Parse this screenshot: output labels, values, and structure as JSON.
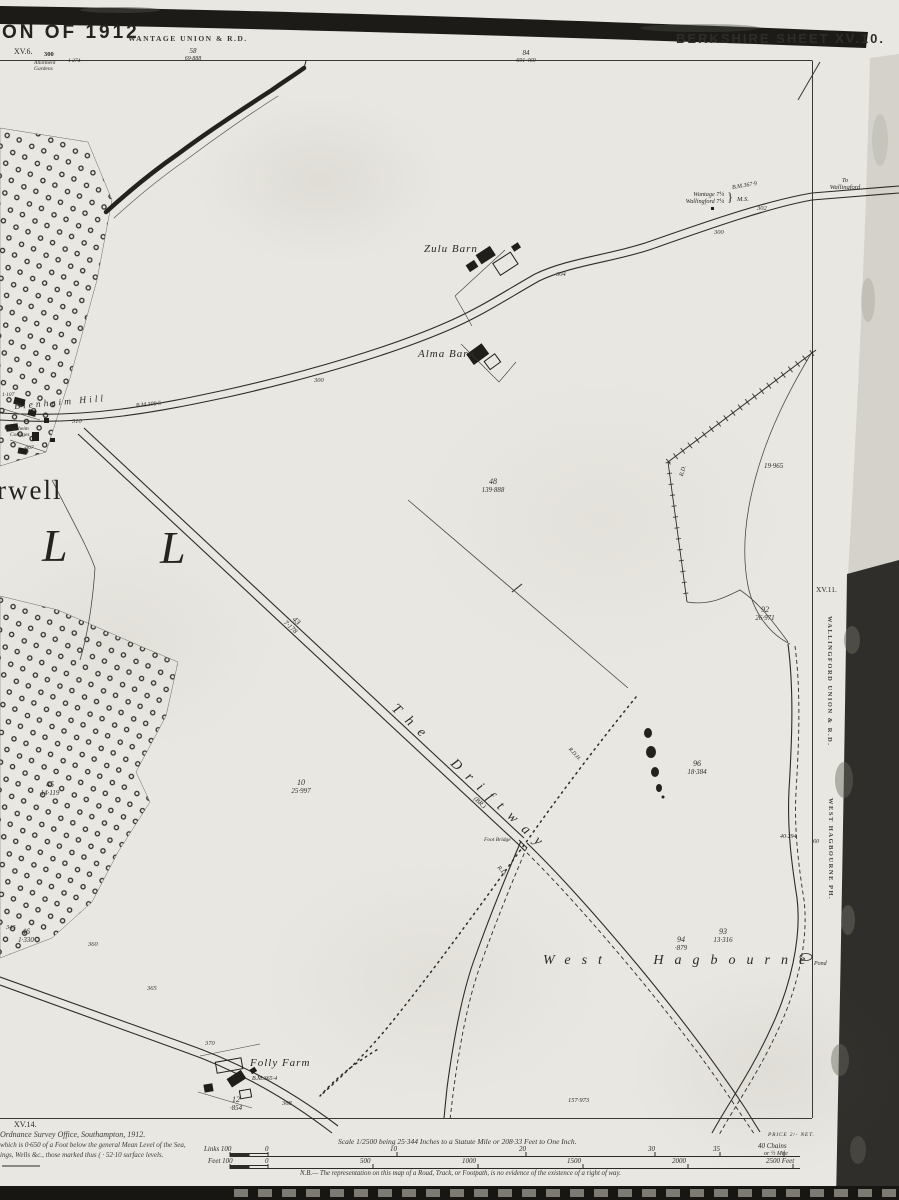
{
  "colors": {
    "paper": "#e9e7e1",
    "ink": "#2c2b26",
    "band": "#1c1b18"
  },
  "header": {
    "edition_partial": "ON OF 1912",
    "union_top": "WANTAGE UNION & R.D.",
    "sheet_title": "BERKSHIRE SHEET XV.10.",
    "ref_top_left": "XV.6.",
    "ref_right": "XV.11.",
    "ref_bottom_left": "XV.14.",
    "allotment_name": "Allotment Gardens",
    "allotment_area": "1·274",
    "top_spot": "300",
    "parcel_left_num": "58",
    "parcel_left_area": "69·888",
    "parcel_mid_num": "84",
    "parcel_mid_area": "691·469"
  },
  "right_margin": {
    "union_vertical": "WALLINGFORD UNION & R.D.",
    "parish_vertical": "WEST HAGBOURNE PH."
  },
  "places": {
    "harwell_partial": "rwell",
    "letter_l1": "L",
    "letter_l2": "L",
    "blenheim_hill": "Blenheim Hill",
    "blenheim_cottages_1": "Blenheim",
    "blenheim_cottages_2": "Cottages",
    "zulu_barn": "Zulu Barn",
    "alma_barn": "Alma Barn",
    "folly_farm": "Folly Farm",
    "driftway": "The Driftway",
    "west_hagbourne": "West Hagbourne",
    "pond": "Pond",
    "to_wallingford_1": "To",
    "to_wallingford_2": "Wallingford",
    "milestone_1": "Wantage 7¼",
    "milestone_2": "Wallingford 7¼",
    "milestone_brace": "}",
    "milestone_ms": "M.S.",
    "br_abbrev": "(BR.)",
    "foot_bridge": "Foot Bridge",
    "rd_1": "R.D.",
    "rd_2": "R.D.",
    "rdh": "R.D.H."
  },
  "benchmarks": {
    "bm1": "B.M.367·9",
    "bm2": "B.M.309·5",
    "bm3": "B.M.365·4"
  },
  "parcels": [
    {
      "num": "48",
      "area": "139·888"
    },
    {
      "num": "43",
      "area": "7·178"
    },
    {
      "num": "10",
      "area": "25·997"
    },
    {
      "num": "45",
      "area": "14·119"
    },
    {
      "num": "46",
      "area": "1·330"
    },
    {
      "num": "92",
      "area": "26·971"
    },
    {
      "num": "96",
      "area": "18·384"
    },
    {
      "num": "93",
      "area": "13·316"
    },
    {
      "num": "94",
      "area": "·879"
    },
    {
      "num": "12",
      "area": "·854"
    }
  ],
  "numbers": {
    "n19": "19·965",
    "n40": "40·294",
    "n60": "60",
    "n157": "157·973",
    "n1107": "1·107",
    "n007": "·007"
  },
  "spot_heights": [
    "310",
    "300",
    "304",
    "300",
    "302",
    "345",
    "360",
    "365",
    "370",
    "368"
  ],
  "legend": {
    "imprint_1": "Ordnance Survey Office, Southampton, 1912.",
    "imprint_2": "which is 0·650 of a Foot below the general Mean Level of the Sea,",
    "imprint_3": "ings, Wells &c., those marked thus ( · 52·10 surface levels.",
    "scale_text": "Scale 1/2500 being 25·344 Inches to a Statute Mile or 208·33 Feet to One Inch.",
    "nb_note": "N.B.— The representation on this map of a Road, Track, or Footpath, is no evidence of the existence of a right of way.",
    "price": "PRICE 2/- NET.",
    "links_label": "Links 100",
    "links_zero": "0",
    "links_ticks": [
      "10",
      "20",
      "30",
      "35"
    ],
    "links_end": "40 Chains",
    "links_end_2": "or ½ Mile",
    "feet_label": "Feet 100",
    "feet_zero": "0",
    "feet_ticks": [
      "500",
      "1000",
      "1500",
      "2000"
    ],
    "feet_end": "2500 Feet"
  }
}
